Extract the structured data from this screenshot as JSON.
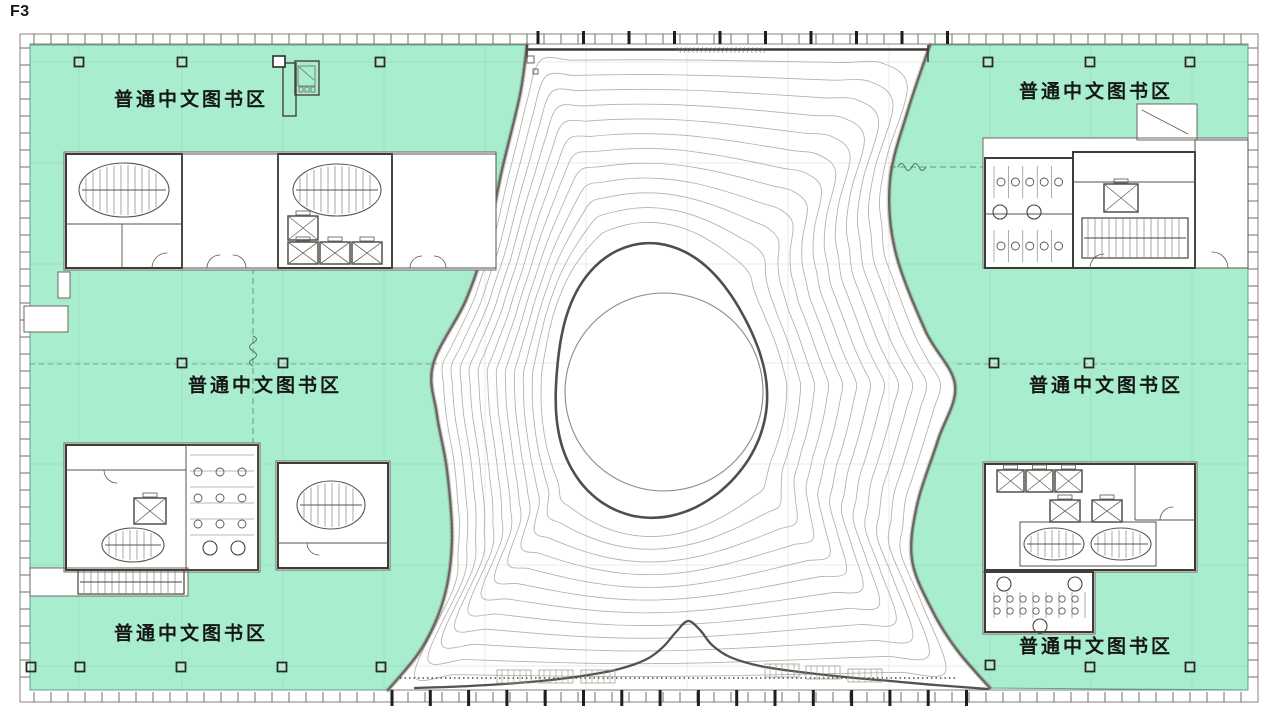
{
  "page": {
    "floor_label": "F3"
  },
  "zones": {
    "items": [
      {
        "id": "top-left",
        "label": "普通中文图书区"
      },
      {
        "id": "top-right",
        "label": "普通中文图书区"
      },
      {
        "id": "mid-left",
        "label": "普通中文图书区"
      },
      {
        "id": "mid-right",
        "label": "普通中文图书区"
      },
      {
        "id": "bottom-left",
        "label": "普通中文图书区"
      },
      {
        "id": "bottom-right",
        "label": "普通中文图书区"
      }
    ]
  },
  "colors": {
    "zone_green": "#a9edcf",
    "wall": "#3f3c38",
    "contour": "#b6afa9",
    "boundary": "#6b665f",
    "grid": "#6e9684",
    "text": "#161616"
  }
}
